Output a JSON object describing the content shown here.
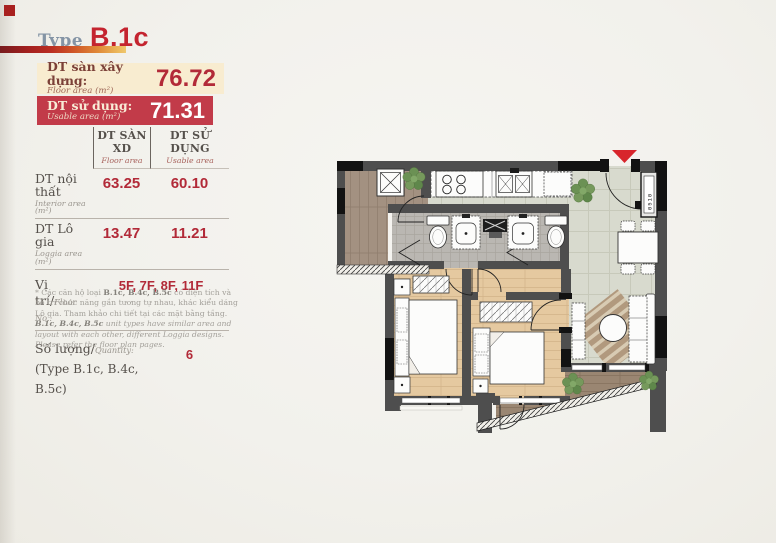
{
  "header": {
    "title_prefix": "Type",
    "title": "B.1c"
  },
  "summary_boxes": [
    {
      "label_vi": "DT sàn xây dựng:",
      "label_en": "Floor area (m²)",
      "value": "76.72"
    },
    {
      "label_vi": "DT sử dụng:",
      "label_en": "Usable area (m²)",
      "value": "71.31"
    }
  ],
  "area_table": {
    "columns": [
      {
        "vi": "DT SÀN XD",
        "en": "Floor area"
      },
      {
        "vi": "DT SỬ DỤNG",
        "en": "Usable area"
      }
    ],
    "rows": [
      {
        "label_vi": "DT nội thất",
        "label_en": "Interior area (m²)",
        "floor": "63.25",
        "usable": "60.10"
      },
      {
        "label_vi": "DT Lô gia",
        "label_en": "Loggia area (m²)",
        "floor": "13.47",
        "usable": "11.21"
      }
    ]
  },
  "location": {
    "label_vi": "Vị trí/",
    "label_en": "Floor No.:",
    "value": "5F, 7F, 8F, 11F"
  },
  "quantity": {
    "label_vi": "Số lượng/",
    "label_en": "Quantity:",
    "type_list": "(Type B.1c, B.4c, B.5c)",
    "value": "6"
  },
  "footnote": {
    "vi_prefix": "* Các căn hộ loại ",
    "vi_bold": "B.1c, B.4c, B.5c",
    "vi_rest": " có diện tích và bố trí chức năng gần tương tự nhau, khác kiểu dáng Lô gia. Tham khảo chi tiết tại các mặt bằng tầng.",
    "en_bold": "B.1c, B.4c, B.5c",
    "en_rest": " unit types have similar area and layout with each other, different Loggia designs. Please refer the floor plan pages."
  },
  "floorplan": {
    "meter_label": "0510"
  },
  "colors": {
    "accent_red": "#c4242f",
    "value_red": "#b22a38",
    "box_cream": "#f8ecd0",
    "box_red": "#c23b49",
    "entry_marker": "#d8262c"
  }
}
